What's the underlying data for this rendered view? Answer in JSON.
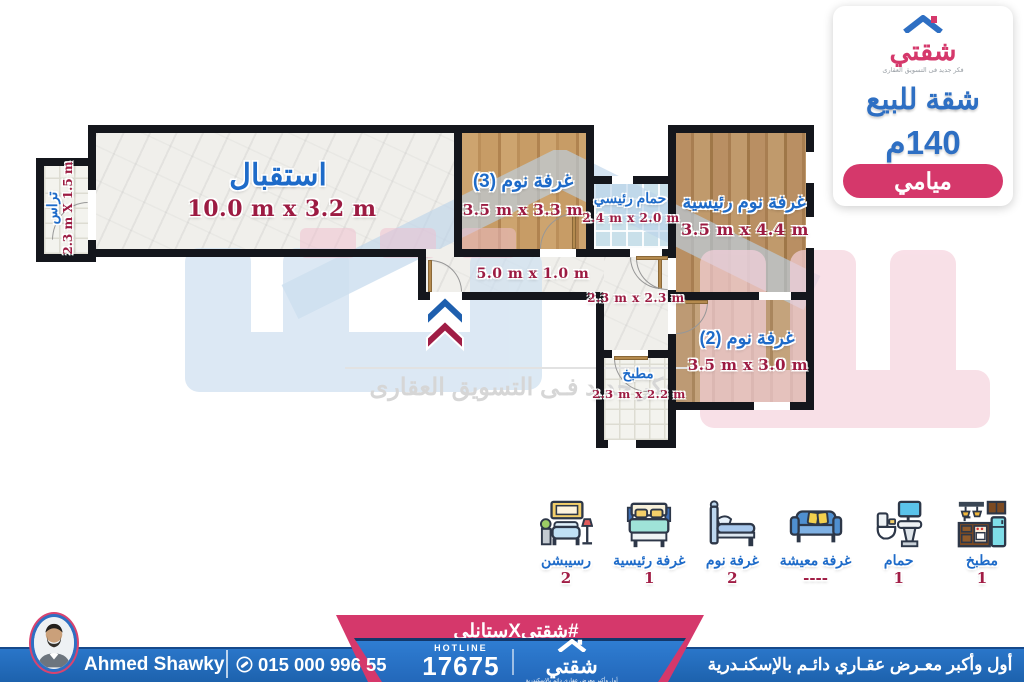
{
  "info_card": {
    "logo_text": "شقتي",
    "logo_tagline": "فكر جديد فى التسويق العقارى",
    "title": "شقة للبيع",
    "area": "140م",
    "location": "ميامي"
  },
  "plan": {
    "rooms": [
      {
        "name": "تراس",
        "dims": "2.3 m X 1.5 m"
      },
      {
        "name": "استقبال",
        "dims": "10.0 m x 3.2 m"
      },
      {
        "name": "غرفة نوم (3)",
        "dims": "3.5 m x 3.3 m"
      },
      {
        "name": "حمام رئيسي",
        "dims": "2.4 m x 2.0 m"
      },
      {
        "name": "غرفة نوم رئيسية",
        "dims": "3.5 m x 4.4 m"
      },
      {
        "name": "",
        "dims": "5.0 m x 1.0 m"
      },
      {
        "name": "",
        "dims": "2.3 m x 2.3 m"
      },
      {
        "name": "غرفة نوم (2)",
        "dims": "3.5 m x 3.0 m"
      },
      {
        "name": "مطبخ",
        "dims": "2.3 m x 2.2 m"
      }
    ],
    "watermark_line": "فكر جديد فـى التسويق العقارى"
  },
  "legend": [
    {
      "label": "رسيبشن",
      "count": "2"
    },
    {
      "label": "غرفة رئيسية",
      "count": "1"
    },
    {
      "label": "غرفة نوم",
      "count": "2"
    },
    {
      "label": "غرفة معيشة",
      "count": "----"
    },
    {
      "label": "حمام",
      "count": "1"
    },
    {
      "label": "مطبخ",
      "count": "1"
    }
  ],
  "footer": {
    "agent_name": "Ahmed Shawky",
    "phone": "015 000 996 55",
    "hashtag": "#شقتيXستانلي",
    "hotline_label": "HOTLINE",
    "hotline_number": "17675",
    "logo_text": "شقتي",
    "logo_tagline": "أول وأكبر معرض عقاري دائم بالإسكندرية",
    "slogan": "أول وأكبر معـرض عقـاري دائـم بالإسكنـدرية"
  },
  "colors": {
    "accent_blue": "#2e6fc3",
    "accent_pink": "#d5386b",
    "label_blue": "#1e6bc9",
    "dim_maroon": "#9c1b42",
    "wall_black": "#14161c"
  }
}
